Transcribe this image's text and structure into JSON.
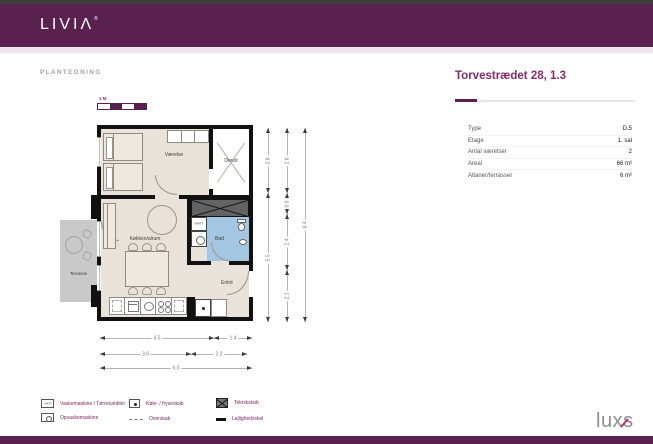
{
  "header": {
    "brand": "LIVIΛ",
    "brand_mark": "®"
  },
  "page": {
    "section_label": "PLANTEGNING",
    "title": "Torvestrædet 28, 1.3"
  },
  "info": {
    "rows": [
      {
        "label": "Type",
        "value": "D.5"
      },
      {
        "label": "Etage",
        "value": "1. sal"
      },
      {
        "label": "Antal værelser",
        "value": "2"
      },
      {
        "label": "Areal",
        "value": "66 m²"
      },
      {
        "label": "Altaner/terrasser",
        "value": "6 m²"
      }
    ]
  },
  "plan": {
    "scale_label": "1 M",
    "rooms": {
      "bedroom": "Værelse",
      "storage": "Depot",
      "kitchen_living": "Køkken/alrum",
      "bathroom": "Bad",
      "hall": "Entré",
      "terrace": "Terrasse",
      "washer_closet": "VM/TT"
    },
    "dimensions": {
      "vertical": [
        [
          "2.8",
          "5.5"
        ],
        [
          "2.8",
          "0.9",
          "2.4",
          "2.1"
        ],
        [
          "8.4"
        ]
      ],
      "horizontal": [
        [
          "4.5",
          "1.4"
        ],
        [
          "3.6",
          "2.2"
        ],
        [
          "6.0"
        ]
      ]
    },
    "colors": {
      "wall": "#111111",
      "floor": "#e9e2da",
      "bathroom": "#a3c6e2",
      "terrace": "#c9c9c9"
    }
  },
  "legend": {
    "items": [
      {
        "icon": "washer-dryer-box",
        "icon_text": "VM/TT",
        "label": "Vaskemaskine / Tørretumbler"
      },
      {
        "icon": "fridge-freezer-dot",
        "label": "Køle- / fryseskab"
      },
      {
        "icon": "technical-cabinet-hatch",
        "label": "Teknikskab"
      },
      {
        "icon": "dishwasher-box",
        "label": "Opvaskemaskine"
      },
      {
        "icon": "upper-cabinet-dashed",
        "label": "Overskab"
      },
      {
        "icon": "party-wall-line",
        "label": "Lejlighedsskel"
      }
    ]
  },
  "footer": {
    "brand": "luxs"
  },
  "theme": {
    "header_purple": "#5b214e",
    "title_purple": "#862a6b",
    "legend_purple": "#7d2462"
  }
}
